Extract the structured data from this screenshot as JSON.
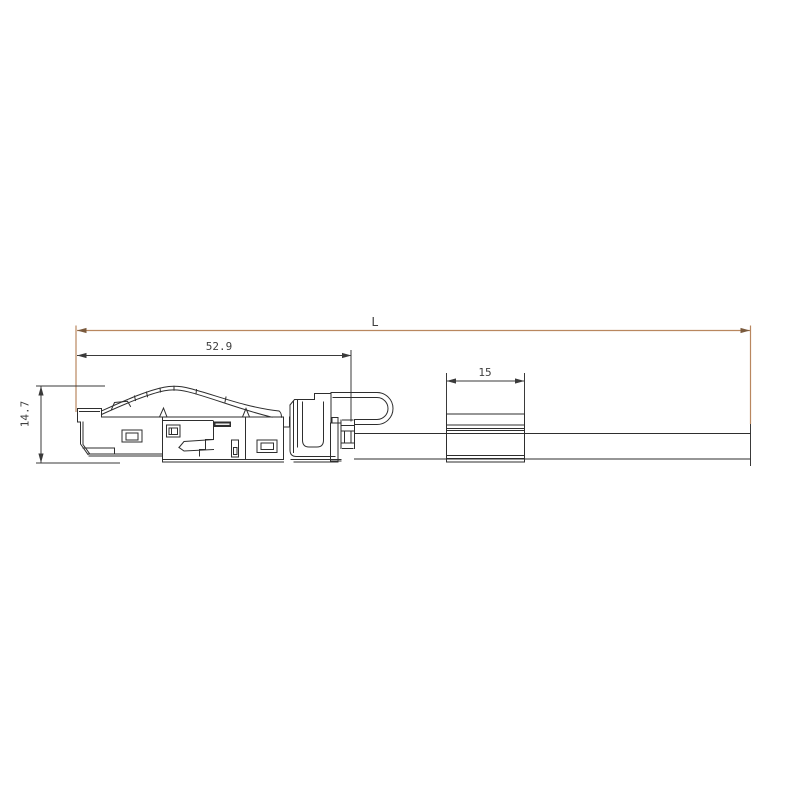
{
  "drawing": {
    "type": "technical-dimension-drawing",
    "subject": "field-terminable plug connector with strain-relief cable loop and label sleeve on cable"
  },
  "dimensions": {
    "overall": {
      "label": "L",
      "orientation": "horizontal",
      "measures": "overall length of connector plus cable"
    },
    "connector": {
      "label": "52.9",
      "orientation": "horizontal",
      "measures": "connector body length"
    },
    "sleeve": {
      "label": "15",
      "orientation": "horizontal",
      "measures": "label sleeve length"
    },
    "height": {
      "label": "14.7",
      "orientation": "vertical",
      "measures": "connector body height"
    }
  },
  "colors": {
    "background": "#ffffff",
    "line": "#2e2e2e",
    "dim": "#3a3a3a",
    "text": "#3f3f3f",
    "accent": "#b9875f",
    "accent_dark": "#7a5a3d"
  }
}
